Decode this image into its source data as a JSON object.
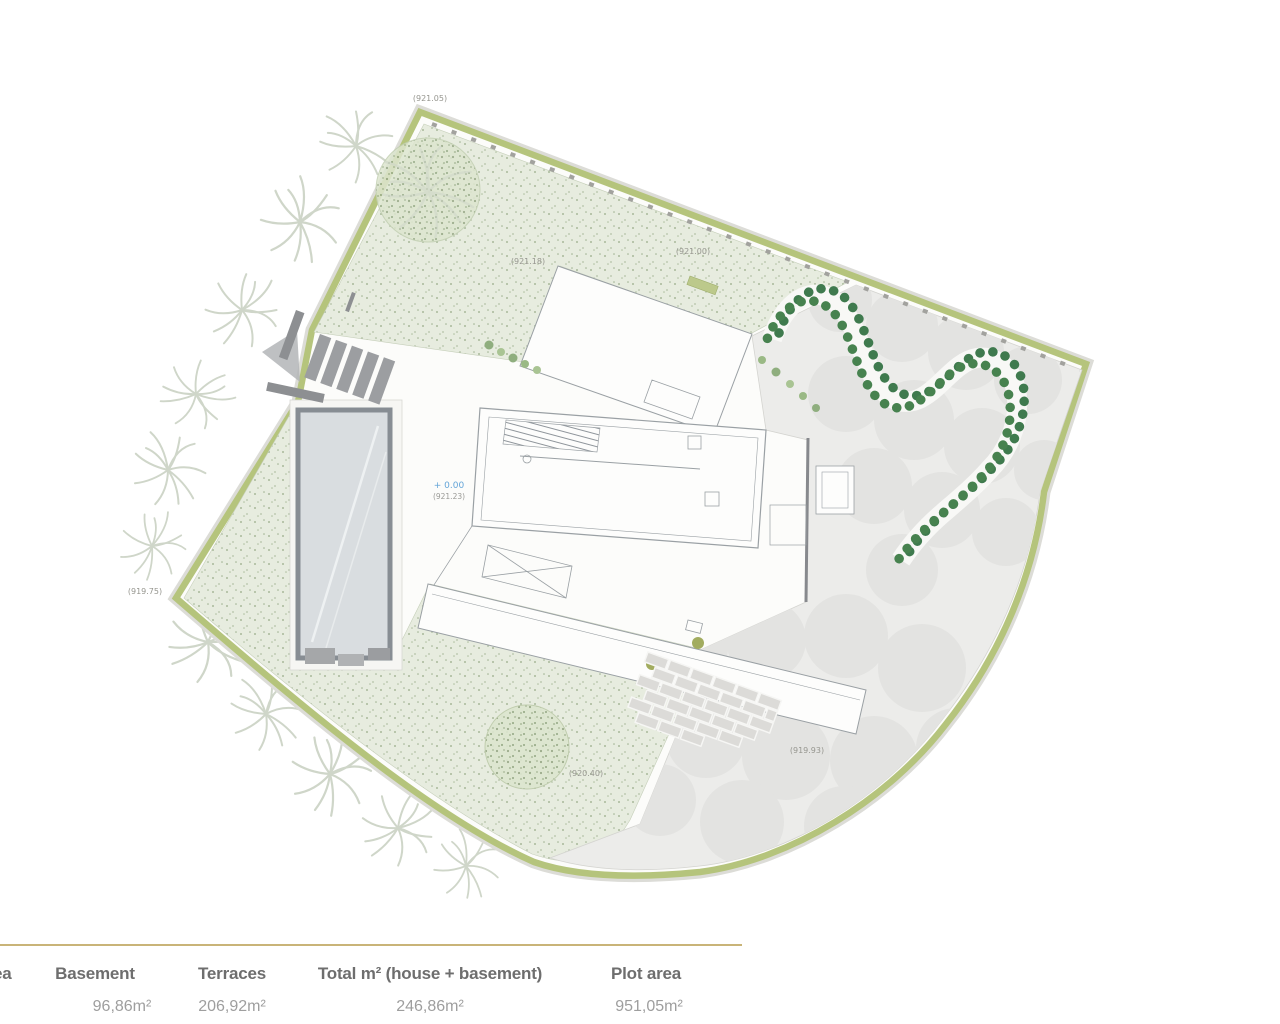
{
  "plan": {
    "elevation_labels": [
      {
        "text": "(921.05)"
      },
      {
        "text": "(921.18)"
      },
      {
        "text": "(921.00)"
      },
      {
        "text": "(919.75)"
      },
      {
        "text": "(920.40)"
      },
      {
        "text": "(919.93)"
      }
    ],
    "level_marker": {
      "value": "+ 0.00",
      "elevation": "(921.23)"
    },
    "colors": {
      "hedge": "#b5c47c",
      "hedge_shrub_dots": "#3f7a4e",
      "garden_stipple": "#e7ecdf",
      "paving": "#ececea",
      "tree_canopy": "#e3e3e1",
      "pool_water": "#d9dde0",
      "level_marker_blue": "#64a5d8",
      "label_gray": "#96968f",
      "divider_gold": "#c9b478"
    }
  },
  "summary": {
    "partial_label": "ea",
    "columns": [
      {
        "label": "Basement",
        "value": "96,86m²"
      },
      {
        "label": "Terraces",
        "value": "206,92m²"
      },
      {
        "label": "Total m² (house + basement)",
        "value": "246,86m²"
      },
      {
        "label": "Plot area",
        "value": "951,05m²"
      }
    ]
  }
}
